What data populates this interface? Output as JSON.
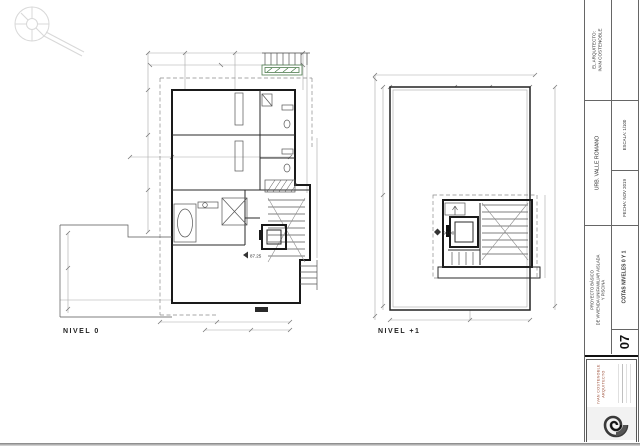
{
  "plans": {
    "nivel0": {
      "label": "NIVEL 0",
      "level_marker": "87.25"
    },
    "nivel1": {
      "label": "NIVEL +1",
      "level_marker": "90.90"
    }
  },
  "title_block": {
    "architect_heading": "EL ARQUITECTO:",
    "architect_name": "IVAN COSTENOBLE",
    "location": "URB. VALLE ROMANO",
    "scale": "ESCALA: 1/100",
    "date": "FECHA: NOV 2019",
    "project": {
      "line1": "PROYECTO BÁSICO",
      "line2": "DE VIVIENDA UNIFAMILIAR AISLADA",
      "line3": "Y PISCINA"
    },
    "sheet_number": "07",
    "sheet_title": "COTAS NIVELES 0 Y 1",
    "logo": {
      "name": "IVAN COSTENOBLE",
      "subtitle": "ARQUITECTO"
    }
  },
  "colors": {
    "planter_green": "#a9c9a0",
    "planter_border": "#4e7d4e",
    "logo_accent": "#9a4a33",
    "dim_gray": "#a8a8a8"
  },
  "icons": {
    "compass": "north-compass-icon",
    "logo": "nautilus-shell-logo"
  }
}
